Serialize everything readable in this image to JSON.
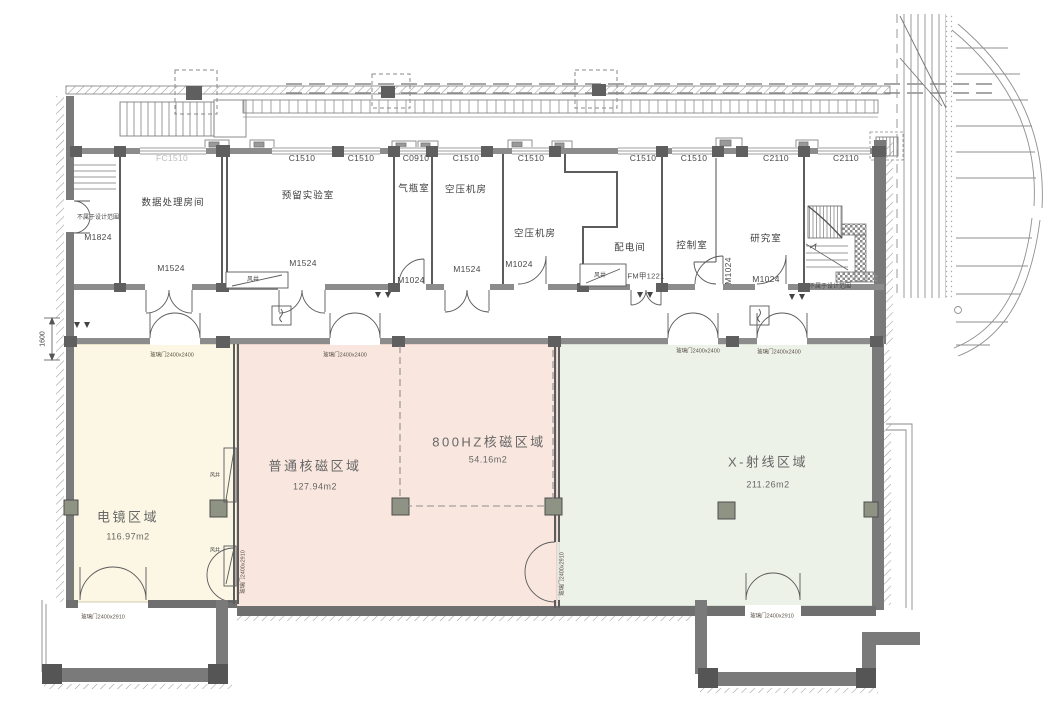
{
  "building": {
    "rooms": [
      "数据处理房间",
      "预留实验室",
      "气瓶室",
      "空压机房",
      "空压机房",
      "配电间",
      "控制室",
      "研究室"
    ],
    "window_codes": [
      "FC1510",
      "C1510",
      "C1510",
      "C0910",
      "C1510",
      "C1510",
      "C1510",
      "C1510",
      "C2110",
      "C2110"
    ],
    "door_codes": {
      "m1824": "M1824",
      "m1524": "M1524",
      "m1024": "M1024",
      "fm": "FM甲1221"
    },
    "zones": [
      {
        "name": "电镜区域",
        "area": "116.97m2",
        "color": "#fbf7e4"
      },
      {
        "name": "普通核磁区域",
        "area": "127.94m2",
        "color": "#f9e7df"
      },
      {
        "name": "800HZ核磁区域",
        "area": "54.16m2",
        "color": "#f9e7df"
      },
      {
        "name": "X-射线区域",
        "area": "211.26m2",
        "color": "#edf2e9"
      }
    ],
    "glass_door_labels": {
      "w2400": "玻璃门2400x2400",
      "w2910": "玻璃门2400x2910"
    },
    "annotations": {
      "out_of_scope": "不属于设计范围",
      "shaft": "风井",
      "dim": "1600"
    }
  }
}
